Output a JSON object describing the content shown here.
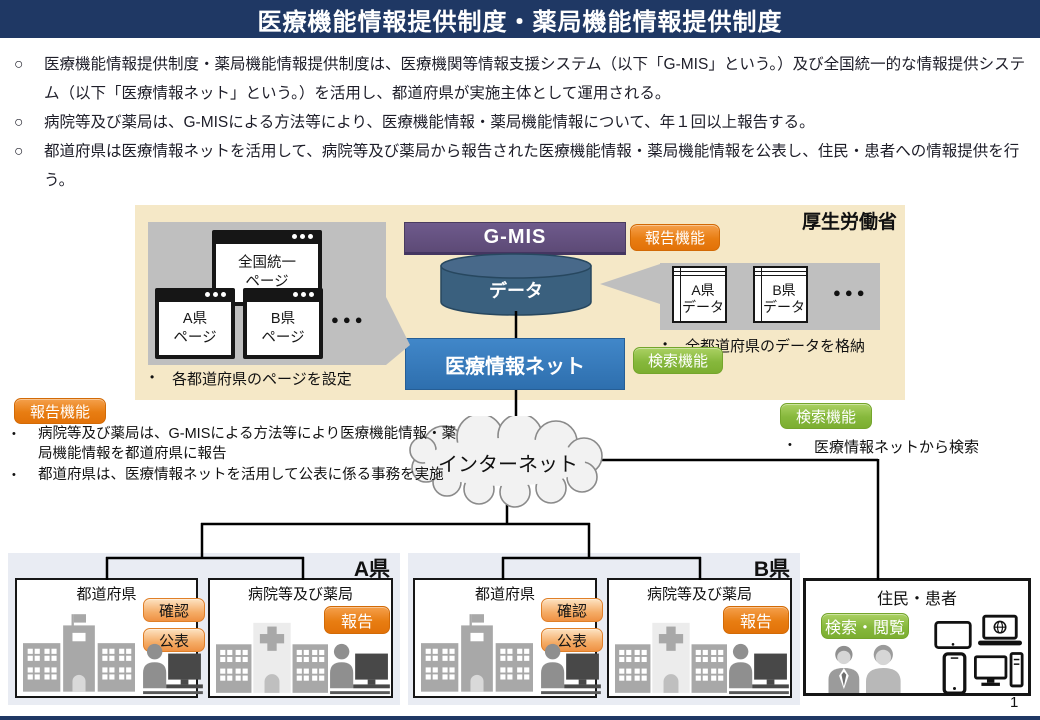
{
  "slide": {
    "title": "医療機能情報提供制度・薬局機能情報提供制度",
    "page_number": "1"
  },
  "intro": {
    "bullets": [
      {
        "marker": "○",
        "text": "医療機能情報提供制度・薬局機能情報提供制度は、医療機関等情報支援システム（以下「G-MIS」という。）及び全国統一的な情報提供システム（以下「医療情報ネット」という。）を活用し、都道府県が実施主体として運用される。"
      },
      {
        "marker": "○",
        "text": "病院等及び薬局は、G-MISによる方法等により、医療機能情報・薬局機能情報について、年１回以上報告する。"
      },
      {
        "marker": "○",
        "text": "都道府県は医療情報ネットを活用して、病院等及び薬局から報告された医療機能情報・薬局機能情報を公表し、住民・患者への情報提供を行う。"
      }
    ]
  },
  "mhlw": {
    "label": "厚生労働省",
    "gmis": "G-MIS",
    "data_store": "データ",
    "net": "医療情報ネット",
    "report_badge": "報告機能",
    "search_badge": "検索機能",
    "pages": {
      "windows": [
        {
          "line1": "全国統一",
          "line2": "ページ"
        },
        {
          "line1": "A県",
          "line2": "ページ"
        },
        {
          "line1": "B県",
          "line2": "ページ"
        }
      ],
      "ellipsis": "●●●",
      "marker": "•",
      "caption": "各都道府県のページを設定"
    },
    "datasets": {
      "tables": [
        {
          "line1": "A県",
          "line2": "データ"
        },
        {
          "line1": "B県",
          "line2": "データ"
        }
      ],
      "ellipsis": "●●●",
      "marker": "•",
      "caption": "全都道府県のデータを格納"
    }
  },
  "report_note": {
    "badge": "報告機能",
    "marker": "•",
    "bullets": [
      "病院等及び薬局は、G-MISによる方法等により医療機能情報・薬局機能情報を都道府県に報告",
      "都道府県は、医療情報ネットを活用して公表に係る事務を実施"
    ]
  },
  "search_note": {
    "badge": "検索機能",
    "marker": "•",
    "bullet": "医療情報ネットから検索"
  },
  "internet": {
    "label": "インターネット"
  },
  "prefectures": [
    {
      "name": "A県",
      "gov": {
        "title": "都道府県",
        "badge_confirm": "確認",
        "badge_publish": "公表"
      },
      "hospital": {
        "title": "病院等及び薬局",
        "badge_report": "報告"
      }
    },
    {
      "name": "B県",
      "gov": {
        "title": "都道府県",
        "badge_confirm": "確認",
        "badge_publish": "公表"
      },
      "hospital": {
        "title": "病院等及び薬局",
        "badge_report": "報告"
      }
    }
  ],
  "residents": {
    "title": "住民・患者",
    "badge": "検索・閲覧"
  },
  "colors": {
    "navy": "#1f3864",
    "beige": "#f5e8c7",
    "purple": "#5d4a76",
    "cylinder_blue": "#3a607e",
    "net_blue": "#2e75b6",
    "orange": "#e87d12",
    "green": "#86b83c",
    "panel_gray": "#bfbfbf",
    "pref_panel": "#e9ecf3"
  }
}
